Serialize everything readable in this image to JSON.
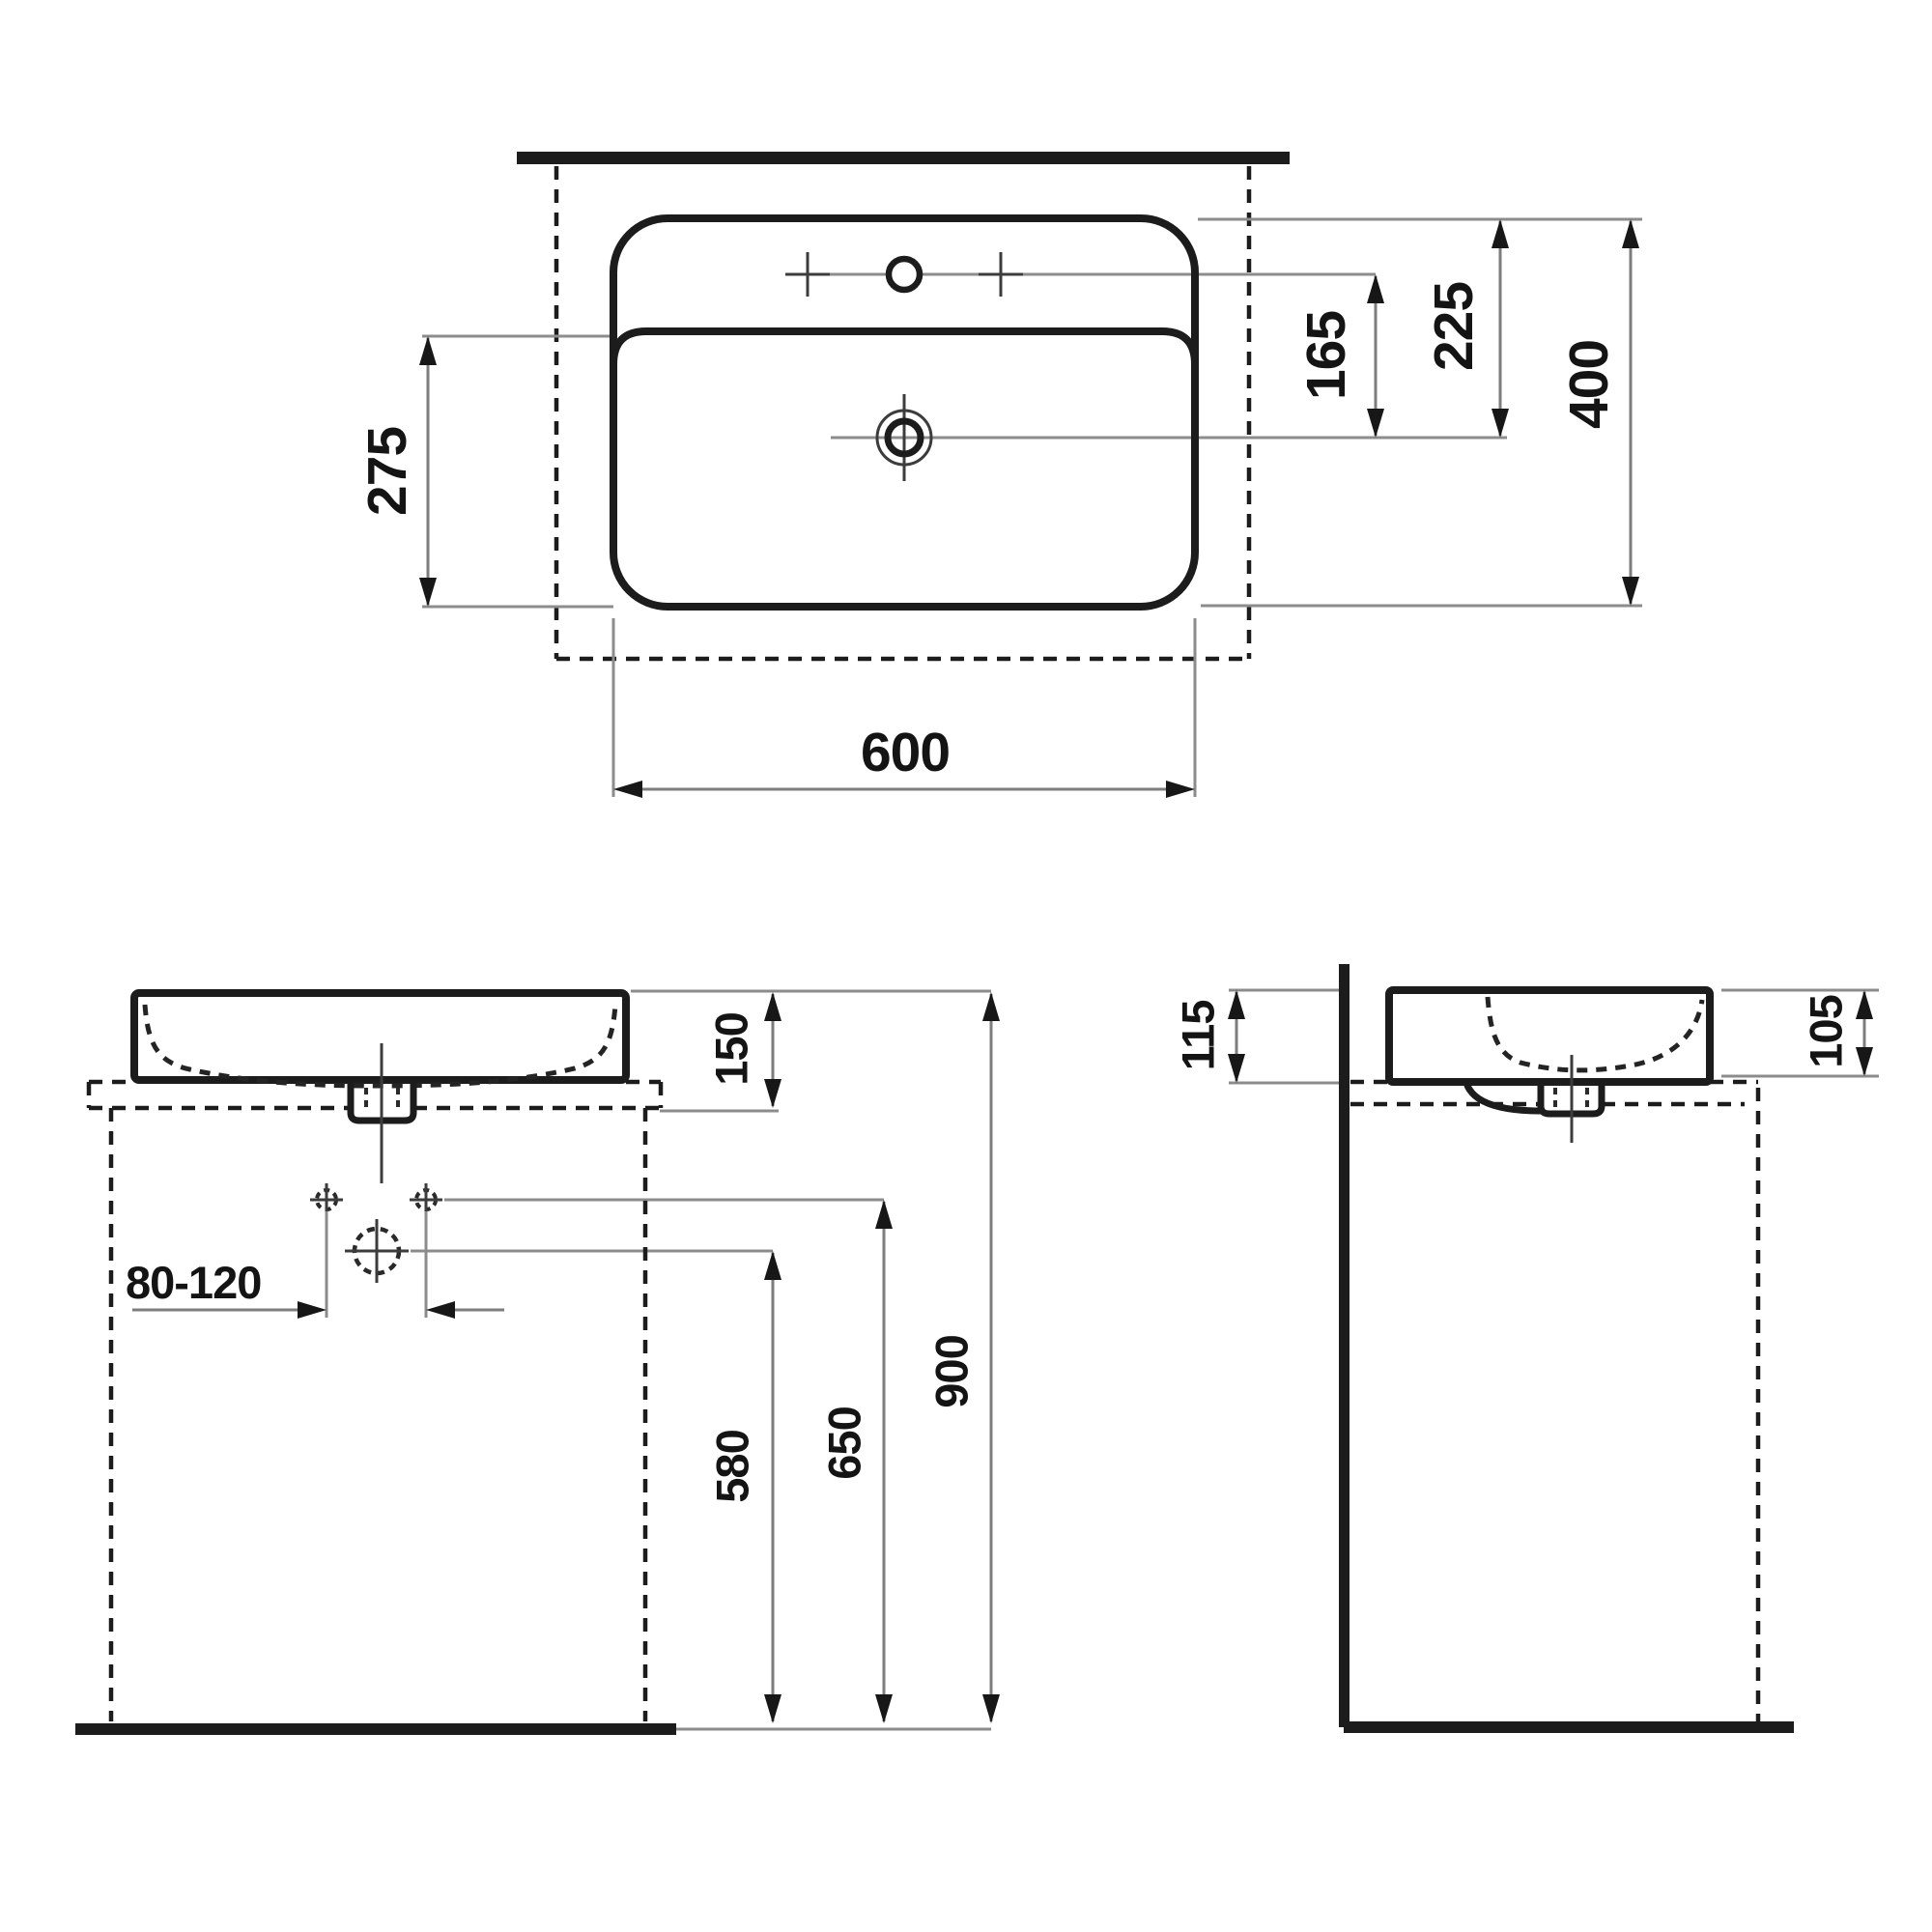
{
  "dimensions": {
    "top_view": {
      "width": "600",
      "depth": "400",
      "front_to_bowl": "275",
      "tap_to_drain": "165",
      "edge_to_drain": "225"
    },
    "front_view": {
      "basin_height": "150",
      "drain_offset_range": "80-120",
      "drain_height": "580",
      "supply_height": "650",
      "rim_height": "900"
    },
    "side_view": {
      "rear_rim_above_counter": "115",
      "front_rim_above_counter": "105"
    }
  }
}
